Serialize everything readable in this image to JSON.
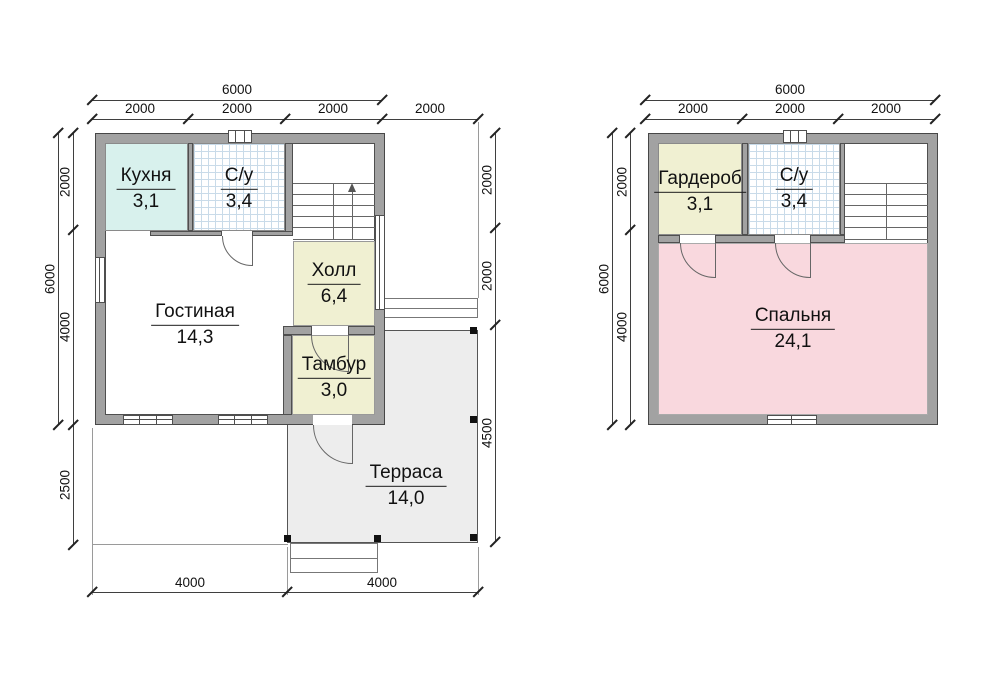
{
  "drawing": {
    "type": "house floor plans",
    "floor_count": 2
  },
  "floor1": {
    "rooms": {
      "kitchen": {
        "name": "Кухня",
        "area": "3,1"
      },
      "bathroom": {
        "name": "С/у",
        "area": "3,4"
      },
      "hall": {
        "name": "Холл",
        "area": "6,4"
      },
      "living": {
        "name": "Гостиная",
        "area": "14,3"
      },
      "tambour": {
        "name": "Тамбур",
        "area": "3,0"
      },
      "terrace": {
        "name": "Терраса",
        "area": "14,0"
      }
    },
    "dims": {
      "top_total": "6000",
      "top_segs": [
        "2000",
        "2000",
        "2000",
        "2000"
      ],
      "left_total": "6000",
      "left_segs": [
        "2000",
        "4000",
        "2500"
      ],
      "right_segs": [
        "2000",
        "2000",
        "4500"
      ],
      "bottom_segs": [
        "4000",
        "4000"
      ]
    }
  },
  "floor2": {
    "rooms": {
      "wardrobe": {
        "name": "Гардероб",
        "area": "3,1"
      },
      "bathroom": {
        "name": "С/у",
        "area": "3,4"
      },
      "bedroom": {
        "name": "Спальня",
        "area": "24,1"
      }
    },
    "dims": {
      "top_total": "6000",
      "top_segs": [
        "2000",
        "2000",
        "2000"
      ],
      "left_total": "6000",
      "left_segs": [
        "2000",
        "4000"
      ]
    }
  },
  "colors": {
    "kitchen_fill": "#d8f1ed",
    "hall_fill": "#f0f0d2",
    "bedroom_fill": "#f9d8de",
    "terrace_fill": "#ededed",
    "wall_fill": "#a2a2a2",
    "tile_line": "#c9dbe9"
  }
}
